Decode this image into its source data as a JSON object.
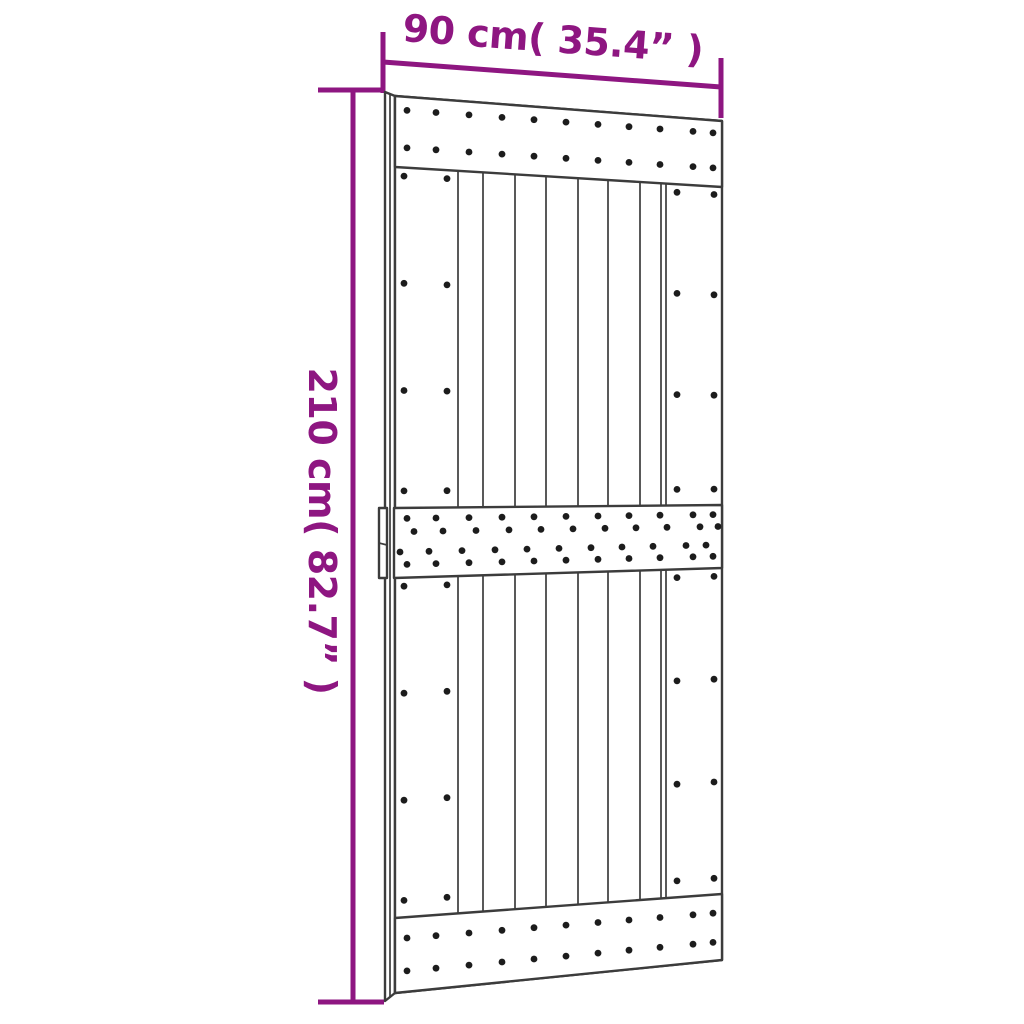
{
  "diagram": {
    "type": "product-dimension-diagram",
    "subject": "sliding barn door with three screwed rails, two vertical plank sections and edge handle"
  },
  "dimensions": {
    "width_label": "90 cm( 35.4” )",
    "height_label": "210 cm( 82.7” )"
  },
  "colors": {
    "dimension_accent": "#8E1681",
    "drawing_line": "#3C3C3C",
    "screw_dot": "#1C1C1C",
    "door_fill": "#FFFFFF",
    "background": "#FFFFFF"
  }
}
